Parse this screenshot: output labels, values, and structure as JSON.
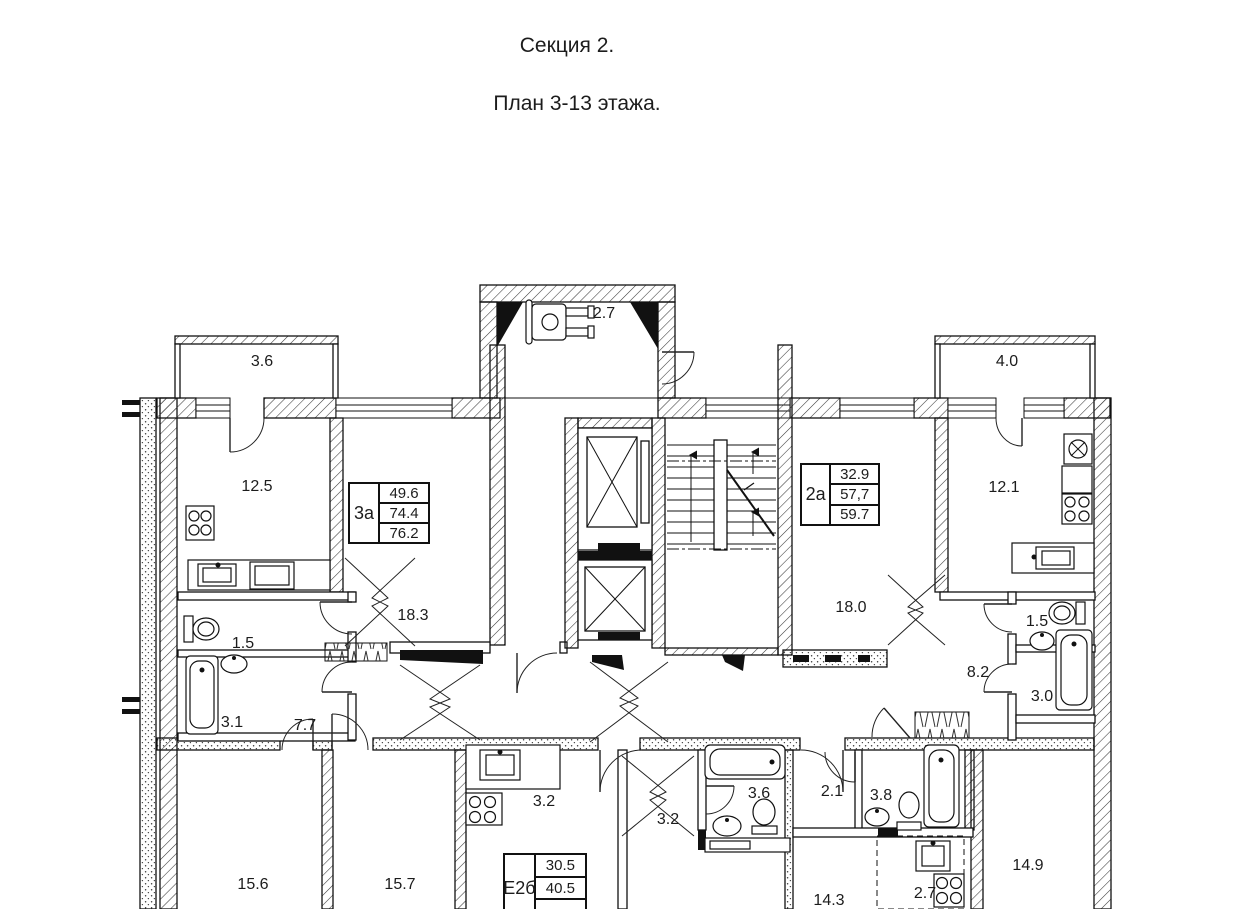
{
  "page_title": {
    "line1": "Секция 2.",
    "line2": "План 3-13 этажа."
  },
  "apartments": [
    {
      "type_label": "3а",
      "rows": [
        "49.6",
        "74.4",
        "76.2"
      ]
    },
    {
      "type_label": "2а",
      "rows": [
        "32.9",
        "57,7",
        "59.7"
      ]
    },
    {
      "type_label": "Е2б",
      "rows": [
        "30.5",
        "40.5"
      ]
    }
  ],
  "rooms": [
    {
      "name": "balcony-left",
      "area": "3.6"
    },
    {
      "name": "kitchen-left",
      "area": "12.5"
    },
    {
      "name": "living-room-left",
      "area": "18.3"
    },
    {
      "name": "wc-left",
      "area": "1.5"
    },
    {
      "name": "bathroom-left",
      "area": "3.1"
    },
    {
      "name": "hall-left",
      "area": "7.7"
    },
    {
      "name": "stroller-room",
      "area": "2.7"
    },
    {
      "name": "living-room-right",
      "area": "18.0"
    },
    {
      "name": "balcony-right",
      "area": "4.0"
    },
    {
      "name": "kitchen-right",
      "area": "12.1"
    },
    {
      "name": "wc-right",
      "area": "1.5"
    },
    {
      "name": "bathroom-right",
      "area": "3.0"
    },
    {
      "name": "hall-right",
      "area": "8.2"
    },
    {
      "name": "bedroom-bottom-1",
      "area": "15.6"
    },
    {
      "name": "bedroom-bottom-2",
      "area": "15.7"
    },
    {
      "name": "kitchen-bottom-center",
      "area": "3.2"
    },
    {
      "name": "hall-bottom-center",
      "area": "3.2"
    },
    {
      "name": "bathroom-bottom-center",
      "area": "3.6"
    },
    {
      "name": "hall-bottom-right",
      "area": "2.1"
    },
    {
      "name": "bathroom-bottom-right",
      "area": "3.8"
    },
    {
      "name": "room-bottom-right",
      "area": "14.3"
    },
    {
      "name": "kitchen-niche",
      "area": "2.7"
    },
    {
      "name": "bedroom-bottom-right",
      "area": "14.9"
    }
  ],
  "colors": {
    "line": "#1c1c1c",
    "background": "#ffffff"
  }
}
